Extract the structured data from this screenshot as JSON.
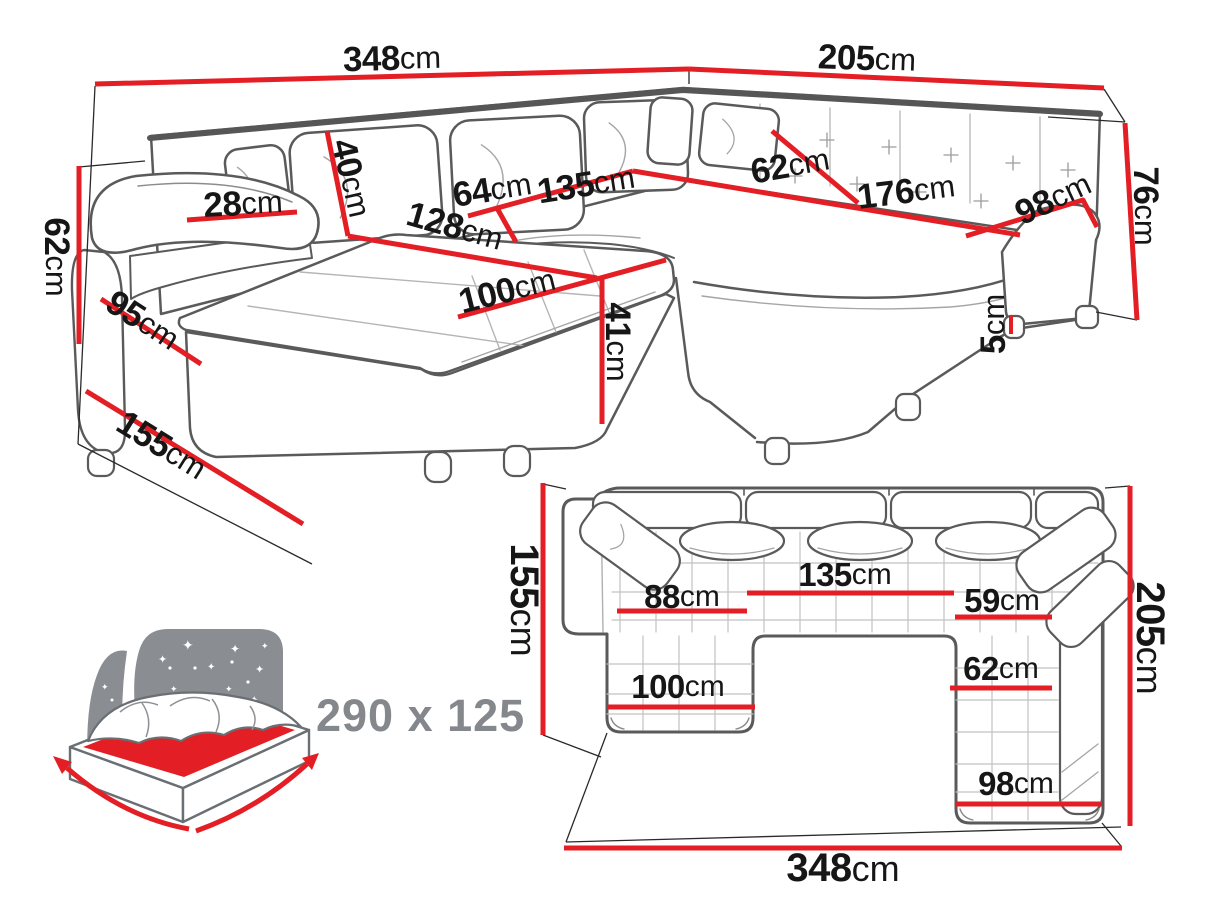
{
  "diagram_title": "corner-sofa-dimension-diagram",
  "unit": "cm",
  "colors": {
    "dimension_line": "#e31e24",
    "label_text": "#161616",
    "sketch_outline": "#5a5a5a",
    "icon_gray": "#84878b"
  },
  "front_view": {
    "dims": {
      "total_width": {
        "v": "348",
        "u": "cm"
      },
      "right_width": {
        "v": "205",
        "u": "cm"
      },
      "back_height": {
        "v": "76",
        "u": "cm"
      },
      "armrest_height": {
        "v": "62",
        "u": "cm"
      },
      "armrest_front_width": {
        "v": "95",
        "u": "cm"
      },
      "left_depth": {
        "v": "155",
        "u": "cm"
      },
      "armrest_top_width": {
        "v": "28",
        "u": "cm"
      },
      "backrest_cushion_height": {
        "v": "40",
        "u": "cm"
      },
      "chaise_diagonal_length": {
        "v": "128",
        "u": "cm"
      },
      "left_seat_depth": {
        "v": "64",
        "u": "cm"
      },
      "middle_seat_width": {
        "v": "135",
        "u": "cm"
      },
      "right_seat_depth": {
        "v": "62",
        "u": "cm"
      },
      "right_seat_width": {
        "v": "176",
        "u": "cm"
      },
      "right_end_depth": {
        "v": "98",
        "u": "cm"
      },
      "chaise_width": {
        "v": "100",
        "u": "cm"
      },
      "seat_height": {
        "v": "41",
        "u": "cm"
      },
      "leg_height": {
        "v": "5",
        "u": "cm"
      }
    }
  },
  "plan_view": {
    "dims": {
      "left_side_depth": {
        "v": "155",
        "u": "cm"
      },
      "chaise_inner_length": {
        "v": "88",
        "u": "cm"
      },
      "middle_seat_width": {
        "v": "135",
        "u": "cm"
      },
      "right_inner_length": {
        "v": "59",
        "u": "cm"
      },
      "right_chaise_width": {
        "v": "62",
        "u": "cm"
      },
      "chaise_width": {
        "v": "100",
        "u": "cm"
      },
      "right_chaise_length": {
        "v": "98",
        "u": "cm"
      },
      "right_side_depth": {
        "v": "205",
        "u": "cm"
      },
      "total_width": {
        "v": "348",
        "u": "cm"
      }
    }
  },
  "sleeping_area": {
    "size_label": "290 x 125"
  }
}
